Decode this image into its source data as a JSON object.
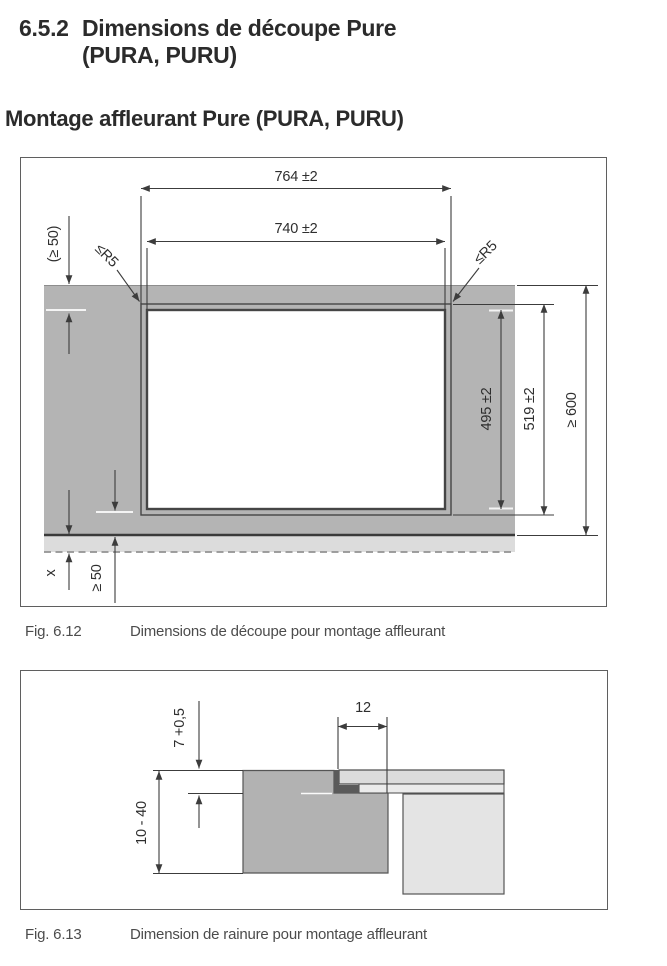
{
  "header": {
    "section_number": "6.5.2",
    "title_line1": "Dimensions de découpe Pure",
    "title_line2": "(PURA, PURU)",
    "subtitle": "Montage affleurant Pure (PURA, PURU)"
  },
  "fig1": {
    "caption_label": "Fig. 6.12",
    "caption_text": "Dimensions de découpe pour montage affleurant",
    "dims": {
      "outer_width": "764 ±2",
      "inner_width": "740 ±2",
      "top_edge_min": "(≥ 50)",
      "corner_radius_left": "≤R5",
      "corner_radius_right": "≤R5",
      "inner_height": "495 ±2",
      "outer_height": "519 ±2",
      "worktop_depth": "≥ 600",
      "front_gap": "x",
      "bottom_edge_min": "≥ 50"
    },
    "colors": {
      "worktop": "#b4b4b4",
      "front_strip": "#dcdcdc",
      "cutout": "#ffffff",
      "line": "#3c3c3c"
    }
  },
  "fig2": {
    "caption_label": "Fig. 6.13",
    "caption_text": "Dimension de rainure pour montage affleurant",
    "dims": {
      "groove_depth": "7 +0,5",
      "worktop_thickness": "10 - 40",
      "groove_width": "12"
    },
    "colors": {
      "worktop": "#b2b2b2",
      "glass_panel": "#dcdcdc",
      "glass_lower_step": "#ebebeb",
      "appliance_body": "#e4e4e4",
      "seal": "#5a5a5a",
      "line": "#3c3c3c"
    }
  }
}
